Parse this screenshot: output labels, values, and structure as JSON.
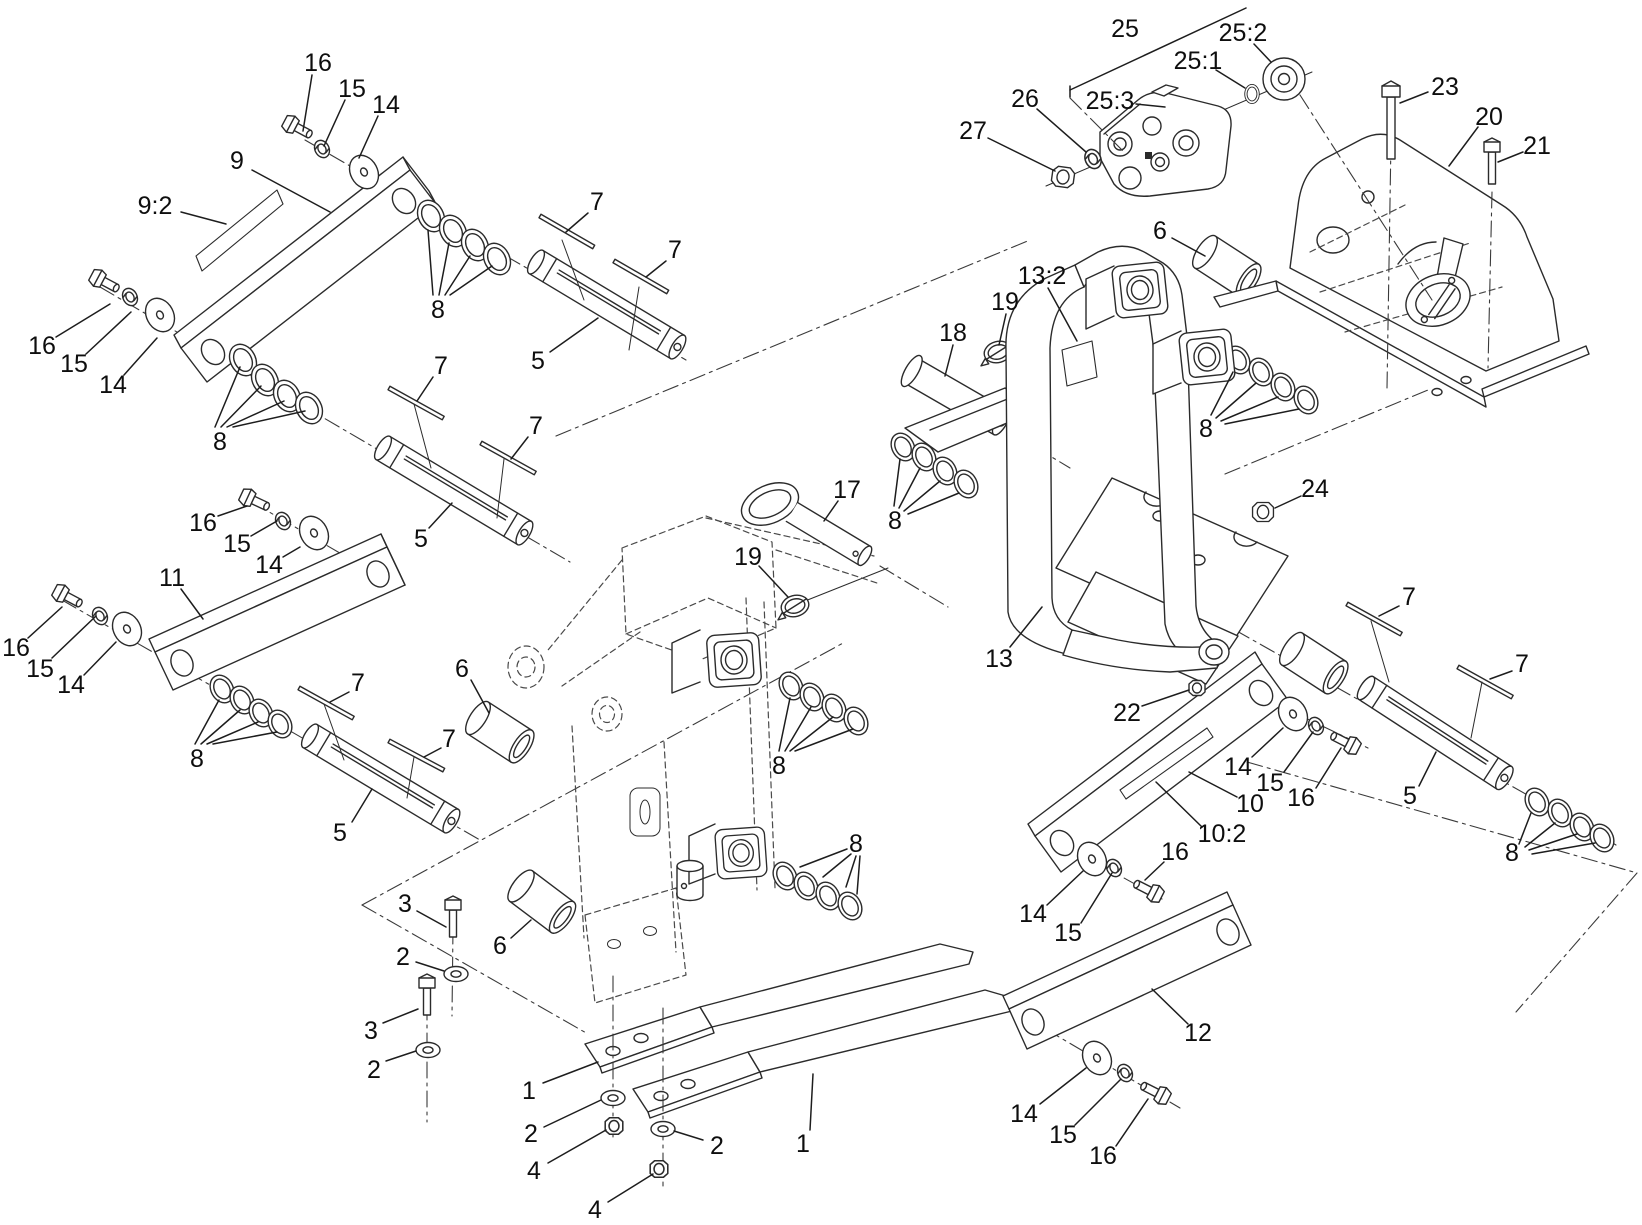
{
  "figure": {
    "type": "exploded-parts-diagram",
    "background": "#ffffff",
    "ink": "#2b2b2b",
    "callout_font_px": 25
  },
  "callouts": [
    {
      "text": "16",
      "x": 318,
      "y": 62,
      "leaders": [
        [
          312,
          75,
          303,
          131
        ]
      ]
    },
    {
      "text": "15",
      "x": 352,
      "y": 88,
      "leaders": [
        [
          345,
          100,
          324,
          146
        ]
      ]
    },
    {
      "text": "14",
      "x": 386,
      "y": 104,
      "leaders": [
        [
          378,
          116,
          359,
          158
        ]
      ]
    },
    {
      "text": "9",
      "x": 237,
      "y": 160,
      "leaders": [
        [
          252,
          170,
          330,
          212
        ]
      ]
    },
    {
      "text": "9:2",
      "x": 155,
      "y": 205,
      "leaders": [
        [
          181,
          212,
          226,
          224
        ]
      ]
    },
    {
      "text": "8",
      "x": 438,
      "y": 309,
      "leaders": [
        [
          433,
          295,
          428,
          230
        ],
        [
          439,
          295,
          449,
          243
        ],
        [
          445,
          295,
          470,
          256
        ],
        [
          450,
          295,
          492,
          266
        ]
      ]
    },
    {
      "text": "7",
      "x": 597,
      "y": 201,
      "leaders": [
        [
          588,
          213,
          566,
          232
        ]
      ]
    },
    {
      "text": "7",
      "x": 675,
      "y": 249,
      "leaders": [
        [
          666,
          261,
          646,
          277
        ]
      ]
    },
    {
      "text": "5",
      "x": 538,
      "y": 360,
      "leaders": [
        [
          550,
          352,
          598,
          318
        ]
      ]
    },
    {
      "text": "16",
      "x": 42,
      "y": 345,
      "leaders": [
        [
          56,
          337,
          110,
          304
        ]
      ]
    },
    {
      "text": "15",
      "x": 74,
      "y": 363,
      "leaders": [
        [
          86,
          354,
          131,
          312
        ]
      ]
    },
    {
      "text": "14",
      "x": 113,
      "y": 384,
      "leaders": [
        [
          124,
          375,
          157,
          338
        ]
      ]
    },
    {
      "text": "8",
      "x": 220,
      "y": 441,
      "leaders": [
        [
          215,
          427,
          240,
          367
        ],
        [
          221,
          427,
          261,
          386
        ],
        [
          227,
          427,
          284,
          401
        ],
        [
          233,
          427,
          305,
          411
        ]
      ]
    },
    {
      "text": "7",
      "x": 441,
      "y": 365,
      "leaders": [
        [
          433,
          377,
          417,
          401
        ]
      ]
    },
    {
      "text": "7",
      "x": 536,
      "y": 425,
      "leaders": [
        [
          528,
          437,
          511,
          459
        ]
      ]
    },
    {
      "text": "5",
      "x": 421,
      "y": 538,
      "leaders": [
        [
          429,
          528,
          452,
          503
        ]
      ]
    },
    {
      "text": "16",
      "x": 203,
      "y": 522,
      "leaders": [
        [
          218,
          516,
          247,
          506
        ]
      ]
    },
    {
      "text": "15",
      "x": 237,
      "y": 543,
      "leaders": [
        [
          251,
          536,
          277,
          521
        ]
      ]
    },
    {
      "text": "14",
      "x": 269,
      "y": 564,
      "leaders": [
        [
          283,
          557,
          300,
          547
        ]
      ]
    },
    {
      "text": "11",
      "x": 172,
      "y": 577,
      "leaders": [
        [
          181,
          589,
          203,
          619
        ]
      ]
    },
    {
      "text": "16",
      "x": 16,
      "y": 647,
      "leaders": [
        [
          28,
          638,
          62,
          607
        ]
      ]
    },
    {
      "text": "15",
      "x": 40,
      "y": 668,
      "leaders": [
        [
          52,
          658,
          96,
          616
        ]
      ]
    },
    {
      "text": "14",
      "x": 71,
      "y": 684,
      "leaders": [
        [
          84,
          675,
          116,
          642
        ]
      ]
    },
    {
      "text": "8",
      "x": 197,
      "y": 758,
      "leaders": [
        [
          195,
          744,
          219,
          700
        ],
        [
          201,
          744,
          240,
          710
        ],
        [
          207,
          744,
          258,
          722
        ],
        [
          213,
          744,
          277,
          732
        ]
      ]
    },
    {
      "text": "7",
      "x": 358,
      "y": 682,
      "leaders": [
        [
          349,
          692,
          330,
          702
        ]
      ]
    },
    {
      "text": "7",
      "x": 449,
      "y": 738,
      "leaders": [
        [
          441,
          748,
          424,
          757
        ]
      ]
    },
    {
      "text": "5",
      "x": 340,
      "y": 832,
      "leaders": [
        [
          352,
          822,
          372,
          789
        ]
      ]
    },
    {
      "text": "6",
      "x": 462,
      "y": 668,
      "leaders": [
        [
          471,
          680,
          489,
          713
        ]
      ]
    },
    {
      "text": "8",
      "x": 779,
      "y": 765,
      "leaders": [
        [
          779,
          751,
          790,
          698
        ],
        [
          785,
          751,
          811,
          707
        ],
        [
          790,
          751,
          833,
          717
        ],
        [
          795,
          751,
          853,
          729
        ]
      ]
    },
    {
      "text": "8",
      "x": 856,
      "y": 843,
      "leaders": [
        [
          847,
          849,
          800,
          867
        ],
        [
          851,
          854,
          823,
          877
        ],
        [
          856,
          856,
          846,
          887
        ],
        [
          860,
          856,
          857,
          894
        ]
      ]
    },
    {
      "text": "3",
      "x": 405,
      "y": 903,
      "leaders": [
        [
          417,
          911,
          446,
          927
        ]
      ]
    },
    {
      "text": "2",
      "x": 403,
      "y": 956,
      "leaders": [
        [
          416,
          962,
          444,
          971
        ]
      ]
    },
    {
      "text": "3",
      "x": 371,
      "y": 1030,
      "leaders": [
        [
          383,
          1023,
          418,
          1009
        ]
      ]
    },
    {
      "text": "2",
      "x": 374,
      "y": 1069,
      "leaders": [
        [
          386,
          1061,
          416,
          1051
        ]
      ]
    },
    {
      "text": "6",
      "x": 500,
      "y": 945,
      "leaders": [
        [
          511,
          938,
          531,
          920
        ]
      ]
    },
    {
      "text": "1",
      "x": 529,
      "y": 1090,
      "leaders": [
        [
          543,
          1083,
          598,
          1062
        ]
      ]
    },
    {
      "text": "2",
      "x": 531,
      "y": 1133,
      "leaders": [
        [
          544,
          1127,
          601,
          1100
        ]
      ]
    },
    {
      "text": "4",
      "x": 534,
      "y": 1170,
      "leaders": [
        [
          548,
          1163,
          606,
          1130
        ]
      ]
    },
    {
      "text": "2",
      "x": 717,
      "y": 1145,
      "leaders": [
        [
          703,
          1140,
          674,
          1131
        ]
      ]
    },
    {
      "text": "4",
      "x": 595,
      "y": 1209,
      "leaders": [
        [
          608,
          1202,
          653,
          1174
        ]
      ]
    },
    {
      "text": "1",
      "x": 803,
      "y": 1143,
      "leaders": [
        [
          810,
          1130,
          813,
          1074
        ]
      ]
    },
    {
      "text": "14",
      "x": 1033,
      "y": 913,
      "leaders": [
        [
          1047,
          905,
          1083,
          871
        ]
      ]
    },
    {
      "text": "15",
      "x": 1068,
      "y": 932,
      "leaders": [
        [
          1081,
          923,
          1112,
          873
        ]
      ]
    },
    {
      "text": "16",
      "x": 1175,
      "y": 851,
      "leaders": [
        [
          1164,
          862,
          1145,
          880
        ]
      ]
    },
    {
      "text": "12",
      "x": 1198,
      "y": 1032,
      "leaders": [
        [
          1188,
          1024,
          1152,
          989
        ]
      ]
    },
    {
      "text": "14",
      "x": 1024,
      "y": 1113,
      "leaders": [
        [
          1040,
          1104,
          1086,
          1068
        ]
      ]
    },
    {
      "text": "15",
      "x": 1063,
      "y": 1134,
      "leaders": [
        [
          1075,
          1125,
          1121,
          1079
        ]
      ]
    },
    {
      "text": "16",
      "x": 1103,
      "y": 1155,
      "leaders": [
        [
          1116,
          1146,
          1148,
          1099
        ]
      ]
    },
    {
      "text": "13",
      "x": 999,
      "y": 658,
      "leaders": [
        [
          1010,
          647,
          1042,
          607
        ]
      ]
    },
    {
      "text": "22",
      "x": 1127,
      "y": 712,
      "leaders": [
        [
          1142,
          706,
          1189,
          690
        ]
      ]
    },
    {
      "text": "14",
      "x": 1238,
      "y": 766,
      "leaders": [
        [
          1252,
          757,
          1283,
          728
        ]
      ]
    },
    {
      "text": "15",
      "x": 1270,
      "y": 782,
      "leaders": [
        [
          1284,
          772,
          1313,
          732
        ]
      ]
    },
    {
      "text": "16",
      "x": 1301,
      "y": 797,
      "leaders": [
        [
          1316,
          788,
          1341,
          748
        ]
      ]
    },
    {
      "text": "10",
      "x": 1250,
      "y": 803,
      "leaders": [
        [
          1237,
          797,
          1189,
          772
        ]
      ]
    },
    {
      "text": "10:2",
      "x": 1222,
      "y": 833,
      "leaders": [
        [
          1202,
          827,
          1156,
          782
        ]
      ]
    },
    {
      "text": "24",
      "x": 1315,
      "y": 488,
      "leaders": [
        [
          1301,
          496,
          1275,
          508
        ]
      ]
    },
    {
      "text": "7",
      "x": 1409,
      "y": 596,
      "leaders": [
        [
          1399,
          606,
          1379,
          616
        ]
      ]
    },
    {
      "text": "7",
      "x": 1522,
      "y": 663,
      "leaders": [
        [
          1512,
          671,
          1490,
          679
        ]
      ]
    },
    {
      "text": "5",
      "x": 1410,
      "y": 795,
      "leaders": [
        [
          1419,
          786,
          1436,
          752
        ]
      ]
    },
    {
      "text": "8",
      "x": 1512,
      "y": 852,
      "leaders": [
        [
          1519,
          844,
          1531,
          813
        ],
        [
          1525,
          847,
          1555,
          823
        ],
        [
          1529,
          850,
          1577,
          834
        ],
        [
          1532,
          854,
          1595,
          843
        ]
      ]
    },
    {
      "text": "25",
      "x": 1125,
      "y": 28,
      "leaders": [
        [
          1070,
          97,
          1070,
          86
        ],
        [
          1070,
          90,
          1246,
          8
        ]
      ]
    },
    {
      "text": "25:2",
      "x": 1243,
      "y": 32,
      "leaders": [
        [
          1254,
          44,
          1271,
          62
        ]
      ]
    },
    {
      "text": "25:1",
      "x": 1198,
      "y": 60,
      "leaders": [
        [
          1216,
          70,
          1245,
          88
        ]
      ]
    },
    {
      "text": "25:3",
      "x": 1110,
      "y": 100,
      "leaders": [
        [
          1136,
          104,
          1165,
          107
        ]
      ]
    },
    {
      "text": "26",
      "x": 1025,
      "y": 98,
      "leaders": [
        [
          1037,
          109,
          1086,
          152
        ]
      ]
    },
    {
      "text": "27",
      "x": 973,
      "y": 130,
      "leaders": [
        [
          988,
          138,
          1055,
          171
        ]
      ]
    },
    {
      "text": "6",
      "x": 1160,
      "y": 230,
      "leaders": [
        [
          1172,
          238,
          1205,
          256
        ]
      ]
    },
    {
      "text": "13:2",
      "x": 1042,
      "y": 275,
      "leaders": [
        [
          1048,
          288,
          1077,
          341
        ]
      ]
    },
    {
      "text": "19",
      "x": 1005,
      "y": 301,
      "leaders": [
        [
          1006,
          314,
          999,
          345
        ]
      ]
    },
    {
      "text": "18",
      "x": 953,
      "y": 332,
      "leaders": [
        [
          953,
          345,
          945,
          376
        ]
      ]
    },
    {
      "text": "8",
      "x": 895,
      "y": 520,
      "leaders": [
        [
          894,
          506,
          900,
          459
        ],
        [
          899,
          508,
          920,
          468
        ],
        [
          904,
          511,
          940,
          481
        ],
        [
          908,
          514,
          959,
          493
        ]
      ]
    },
    {
      "text": "8",
      "x": 1206,
      "y": 428,
      "leaders": [
        [
          1211,
          415,
          1233,
          372
        ],
        [
          1216,
          418,
          1256,
          383
        ],
        [
          1221,
          421,
          1278,
          397
        ],
        [
          1225,
          424,
          1299,
          409
        ]
      ]
    },
    {
      "text": "17",
      "x": 847,
      "y": 489,
      "leaders": [
        [
          838,
          501,
          824,
          521
        ]
      ]
    },
    {
      "text": "19",
      "x": 748,
      "y": 556,
      "leaders": [
        [
          759,
          566,
          788,
          597
        ]
      ]
    },
    {
      "text": "23",
      "x": 1445,
      "y": 86,
      "leaders": [
        [
          1428,
          92,
          1400,
          103
        ]
      ]
    },
    {
      "text": "20",
      "x": 1489,
      "y": 116,
      "leaders": [
        [
          1478,
          127,
          1449,
          166
        ]
      ]
    },
    {
      "text": "21",
      "x": 1537,
      "y": 145,
      "leaders": [
        [
          1523,
          152,
          1498,
          162
        ]
      ]
    }
  ]
}
